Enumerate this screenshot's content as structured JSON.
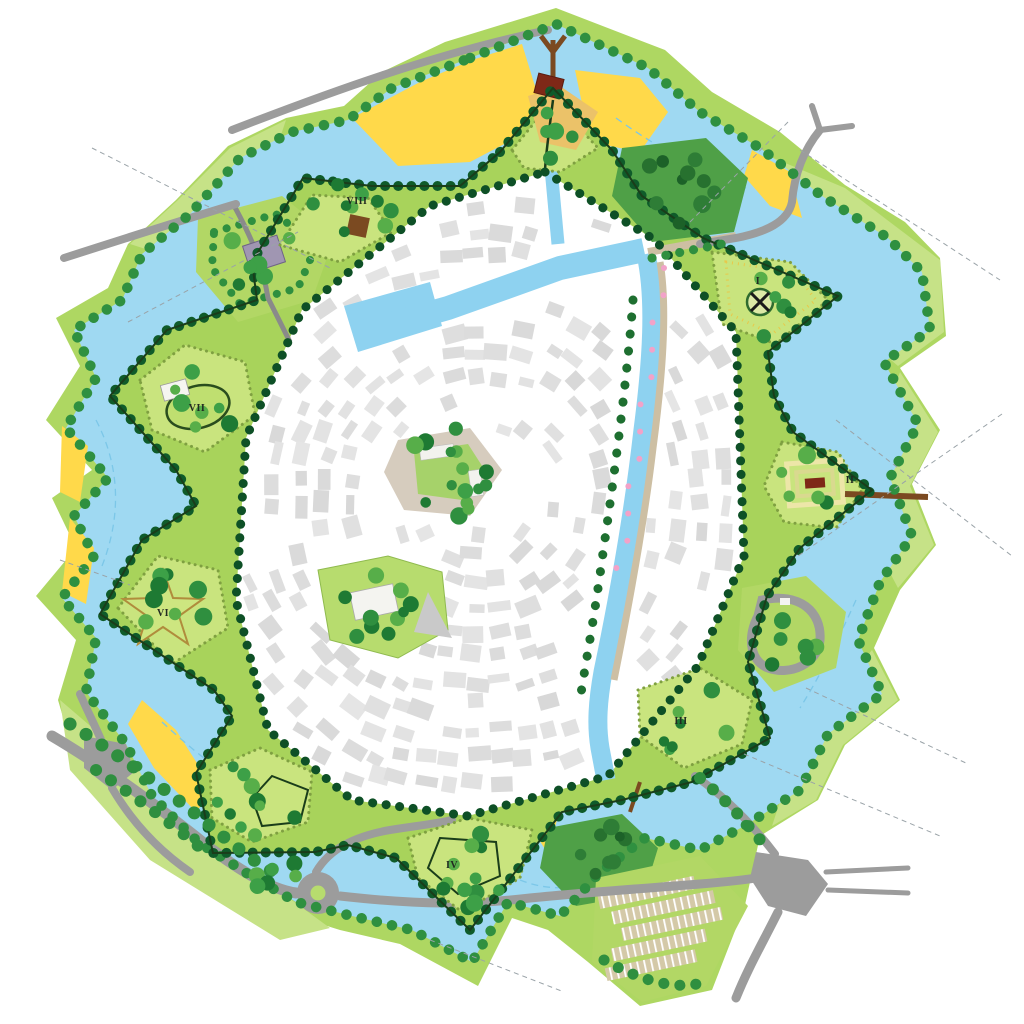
{
  "map": {
    "kind": "fortified-town-plan",
    "bastions": [
      {
        "label": "I"
      },
      {
        "label": "II"
      },
      {
        "label": "III"
      },
      {
        "label": "IV"
      },
      {
        "label": "VI"
      },
      {
        "label": "VII"
      },
      {
        "label": "VIII"
      }
    ],
    "icons": {
      "windmill": "windmill-x-icon",
      "star_garden": "star-parterre-icon",
      "labyrinth": "labyrinth-garden-icon"
    },
    "colors": {
      "water": "#9FD9F2",
      "canal": "#8ED2F0",
      "glacis": "#AED762",
      "glacis_light": "#C6E287",
      "rampart": "#A8D35B",
      "bastion_lawn": "#C9E47E",
      "tree_dark": "#0F5B2A",
      "tree_mid": "#2F8F3F",
      "sand_yellow": "#FFD94A",
      "beach_sand": "#EBC269",
      "road": "#9C9C9C",
      "city_block": "#DDDDDD",
      "jetty_brown": "#7B4A21",
      "building_red": "#7E2817",
      "building_purple": "#A096B2",
      "quay_pink": "#F2A2C8"
    }
  }
}
